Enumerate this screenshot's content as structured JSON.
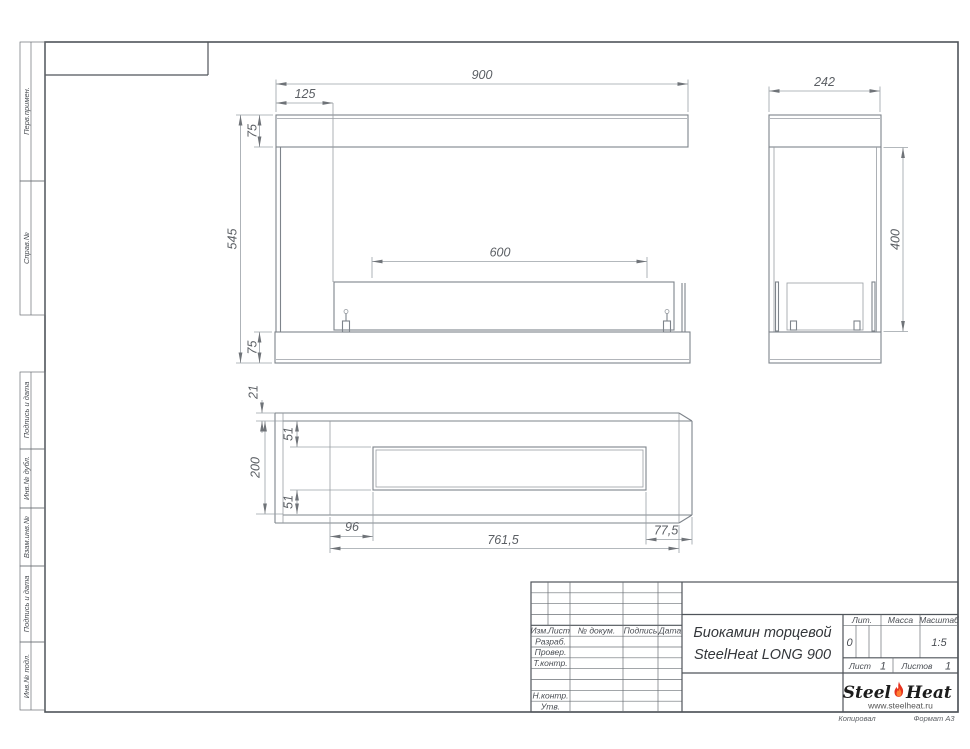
{
  "sheet": {
    "copied": "Копировал",
    "format": "Формат А3"
  },
  "colors": {
    "flame_red": "#e6321e",
    "flame_inner": "#ff8033",
    "line_gray": "#7e848b"
  },
  "sidebar": {
    "items": [
      {
        "label": "Перв.примен."
      },
      {
        "label": "Справ.№"
      },
      {
        "label": "Подпись и дата"
      },
      {
        "label": "Инв.№ дубл."
      },
      {
        "label": "Взам.инв.№"
      },
      {
        "label": "Подпись и дата"
      },
      {
        "label": "Инв.№ подл."
      }
    ]
  },
  "title_block": {
    "cols": [
      "Изм.",
      "Лист",
      "№ докум.",
      "Подпись",
      "Дата"
    ],
    "rows": [
      "Разраб.",
      "Провер.",
      "Т.контр.",
      "Н.контр.",
      "Утв."
    ],
    "title_line1": "Биокамин торцевой",
    "title_line2": "SteelHeat LONG 900",
    "lit_label": "Лит.",
    "lit_value": "0",
    "mass_label": "Масса",
    "scale_label": "Масштаб",
    "scale_value": "1:5",
    "sheet_label": "Лист",
    "sheet_value": "1",
    "sheets_label": "Листов",
    "sheets_value": "1",
    "logo_steel": "Steel",
    "logo_heat": "Heat",
    "logo_url": "www.steelheat.ru"
  },
  "dims": {
    "front": {
      "total_width": "900",
      "left_offset": "125",
      "lintel_height": "75",
      "total_height": "545",
      "base_height": "75",
      "burner_width": "600"
    },
    "side": {
      "depth": "242",
      "opening_height": "400"
    },
    "plan": {
      "wall_thickness": "21",
      "inset_top": "51",
      "depth": "200",
      "inset_bottom": "51",
      "left_offset": "96",
      "length": "761,5",
      "right_offset": "77,5"
    }
  }
}
